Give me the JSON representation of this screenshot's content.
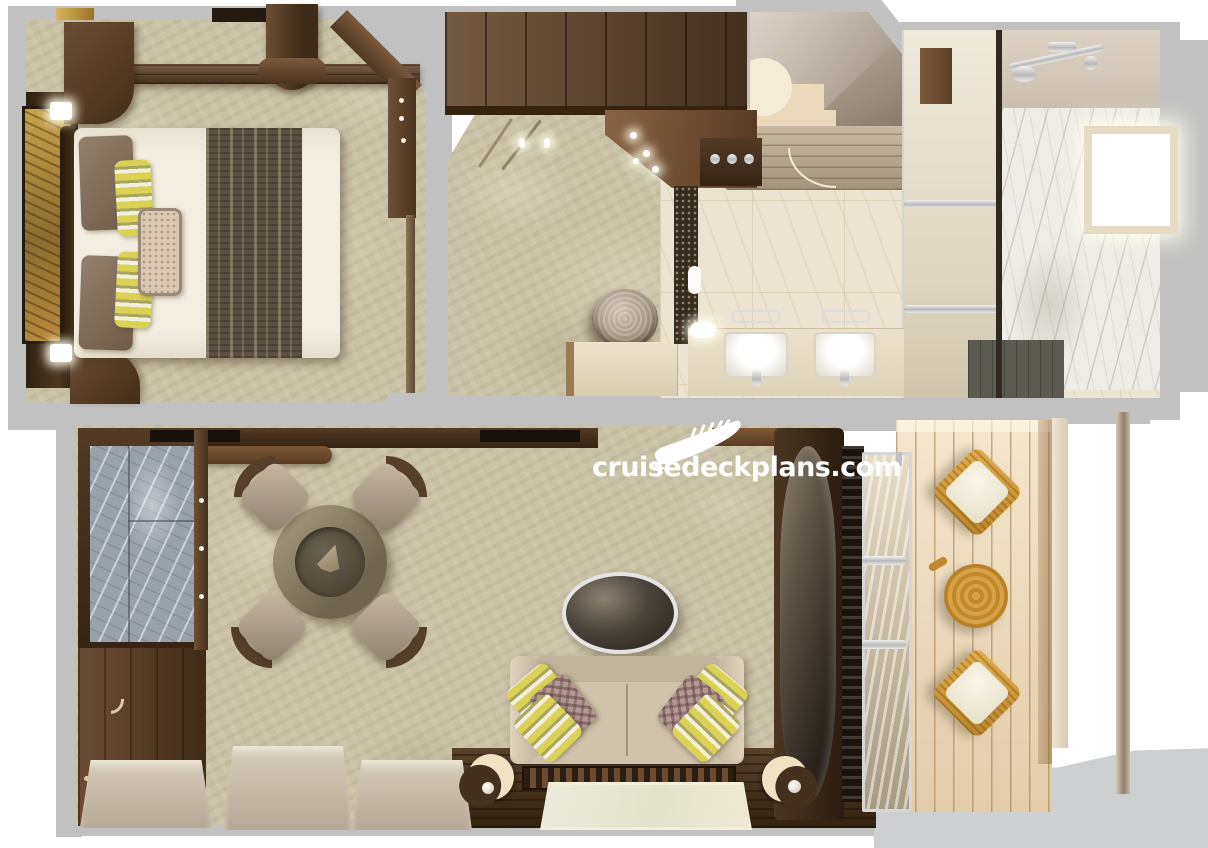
{
  "watermark": {
    "text": "cruisedeckplans.com",
    "icon": "cruise-ship-icon",
    "color": "#ffffff"
  },
  "palette": {
    "wall": "#c1c1c1",
    "carpet": "#c9c2a6",
    "wood": "#5d432c",
    "woodDark": "#3c2a1a",
    "deck": "#ecd9ba",
    "wicker": "#d79f3e",
    "marbleBath": "#ece4d2",
    "marbleWall": "#edece6",
    "marbleGray": "#99a1ab",
    "slate": "#5c5b51",
    "duvet": "#f1ecdf",
    "runner": "#5a5142",
    "sofa": "#cfc3ac",
    "pillowYellow": "#d9d254",
    "lampCream": "#f0e3c1",
    "artAmber": "#c28a33",
    "white": "#ffffff"
  },
  "plan": {
    "type": "cruise-suite-floor-plan",
    "rooms": [
      {
        "name": "bedroom",
        "furniture": [
          "king-bed",
          "striped-bed-runner",
          "headboard-artwork",
          "wall-sconce",
          "wall-sconce",
          "nightstand",
          "nightstand",
          "wardrobe",
          "desk-ledge"
        ]
      },
      {
        "name": "dressing-area",
        "furniture": [
          "wardrobe",
          "closet-doors",
          "canopy-downlights",
          "round-ottoman",
          "bench"
        ]
      },
      {
        "name": "entry-hall",
        "furniture": [
          "door-swing"
        ]
      },
      {
        "name": "bathroom",
        "furniture": [
          "double-vanity",
          "sink",
          "sink",
          "towel-bar",
          "towel-bar",
          "shower",
          "frosted-glass-partition",
          "marble-wall",
          "window",
          "slate-shower-floor",
          "mosaic-strip"
        ]
      },
      {
        "name": "living-room",
        "furniture": [
          "bar-counter-marble",
          "bar-cabinet",
          "round-dining-table",
          "dining-chair",
          "dining-chair",
          "dining-chair",
          "dining-chair",
          "oval-coffee-table",
          "sofa",
          "accent-pillows",
          "rear-console",
          "art-rug-panel",
          "crescent-lamp",
          "crescent-lamp",
          "curtain-panel",
          "curtain-panel",
          "curtain-panel",
          "curved-tv-panel",
          "sliding-glass-door"
        ]
      },
      {
        "name": "balcony",
        "furniture": [
          "wicker-chair",
          "wicker-chair",
          "wicker-side-table",
          "partition-pole"
        ]
      }
    ]
  }
}
